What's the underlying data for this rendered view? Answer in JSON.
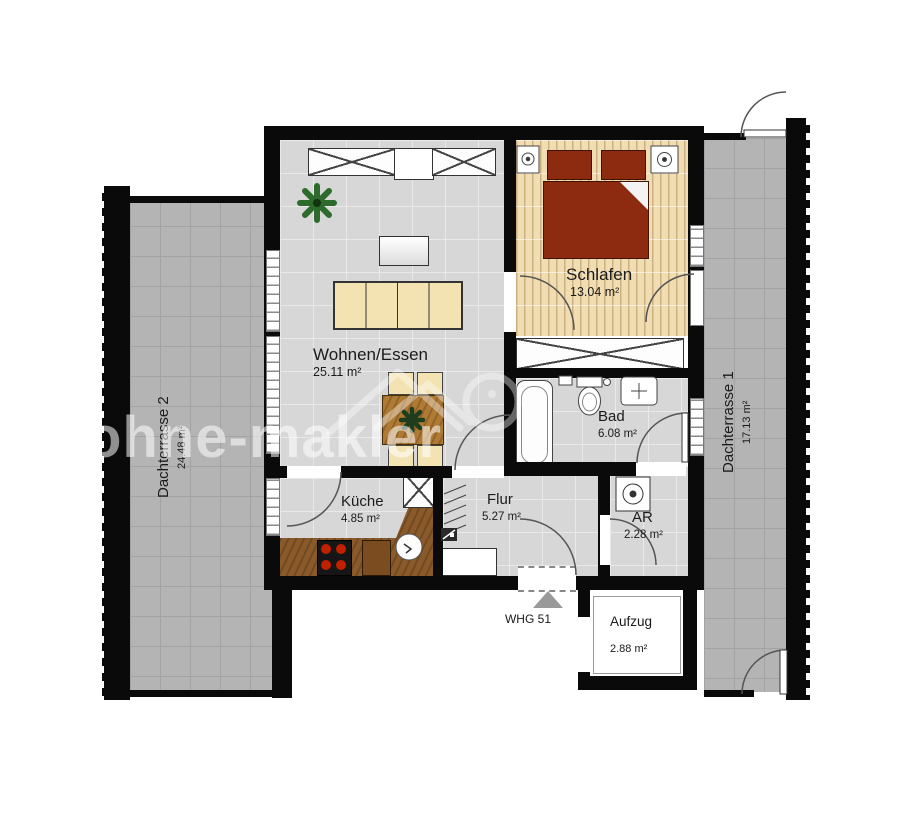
{
  "watermark": {
    "text": "ohne-makler"
  },
  "unit": {
    "label": "WHG 51"
  },
  "rooms": {
    "wohnen": {
      "name": "Wohnen/Essen",
      "area": "25.11 m²"
    },
    "schlafen": {
      "name": "Schlafen",
      "area": "13.04 m²"
    },
    "bad": {
      "name": "Bad",
      "area": "6.08 m²"
    },
    "kueche": {
      "name": "Küche",
      "area": "4.85 m²"
    },
    "flur": {
      "name": "Flur",
      "area": "5.27 m²"
    },
    "ar": {
      "name": "AR",
      "area": "2.28 m²"
    },
    "aufzug": {
      "name": "Aufzug",
      "area": "2.88 m²"
    },
    "terrasse2": {
      "name": "Dachterrasse 2",
      "area": "24.48 m²"
    },
    "terrasse1": {
      "name": "Dachterrasse 1",
      "area": "17.13 m²"
    }
  },
  "colors": {
    "wall": "#0a0a0a",
    "terrace_floor": "#b4b4b4",
    "terrace_grid": "#a3a3a3",
    "interior_floor": "#d7d7d7",
    "interior_grid": "#e9e9e9",
    "wood_floor": "#f0ddb4",
    "bed": "#8c2b10",
    "sofa": "#f3e3b2",
    "counter": "#8a5a2a",
    "burner": "#c22000",
    "entrance_marker": "#999999",
    "label_text": "#1b1b1b",
    "watermark": "#ffffff"
  }
}
